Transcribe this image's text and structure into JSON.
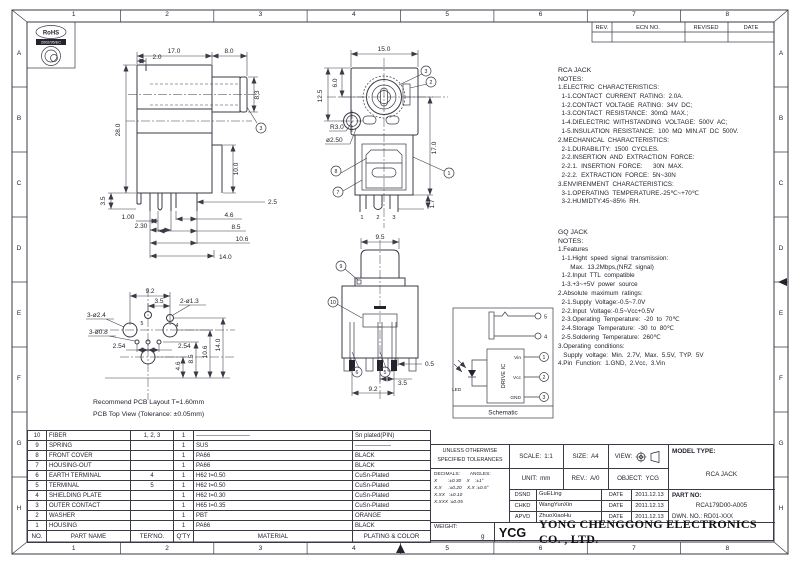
{
  "sheet": {
    "columns": [
      "1",
      "2",
      "3",
      "4",
      "5",
      "6",
      "7",
      "8"
    ],
    "rows": [
      "A",
      "B",
      "C",
      "D",
      "E",
      "F",
      "G",
      "H"
    ],
    "revision": {
      "headers": [
        "REV.",
        "ECN NO.",
        "REVISED",
        "DATE"
      ]
    },
    "rohs": {
      "title": "RoHS",
      "subtitle": "2002/95/EC"
    }
  },
  "notes_rca": {
    "title": "RCA JACK",
    "label": "NOTES:",
    "lines": [
      "1.ELECTRIC  CHARACTERISTICS:",
      "  1-1.CONTACT  CURRENT  RATING:  2.0A.",
      "  1-2.CONTACT  VOLTAGE  RATING:  34V  DC;",
      "  1-3.CONTACT  RESISTANCE:  30mΩ  MAX.;",
      "  1-4.DIELECTRIC  WITHSTANDING  VOLTAGE:  500V  AC;",
      "  1-5.INSULATION  RESISTANCE:  100  MΩ  MIN.AT  DC  500V.",
      "2.MECHANICAL  CHARACTERISTICS:",
      "  2-1.DURABILITY:  1500  CYCLES.",
      "  2-2.INSERTION  AND  EXTRACTION  FORCE:",
      "  2-2.1.  INSERTION  FORCE:      30N  MAX.",
      "  2-2.2.  EXTRACTION  FORCE:  5N~30N",
      "3.ENVIRENMENT  CHARACTERISTICS:",
      "  3-1.OPERATING  TEMPERATURE.-25℃~+70℃",
      "  3-2.HUMIDTY:45~85%  RH."
    ]
  },
  "notes_gq": {
    "title": "GQ JACK",
    "label": "NOTES:",
    "lines": [
      "1.Features",
      "  1-1.Hight  speed  signal  transmission:",
      "       Max.  13.2Mbps,(NRZ  signal)",
      "  1-2.Input  TTL  compatible",
      "  1-3.+3~+5V  power  source",
      "2.Absolute  maximum  ratings:",
      "  2-1.Supply  Voltage:-0.5~7.0V",
      "  2-2.Input  Voltage:-0.5~Vcc+0.5V",
      "  2-3.Operating  Temperature:  -20  to  70℃",
      "  2-4.Storage  Temperature:  -30  to  80℃",
      "  2-5.Soldering  Temperature:  260℃",
      "3.Operating  conditions:",
      "   Supply  voltage:  Min.  2.7V,  Max.  5.5V,  TYP.  5V",
      "4.Pin  Function:  1.GND,  2.Vcc,  3.Vin"
    ]
  },
  "views": {
    "side": {
      "balloon": "3",
      "dims": {
        "w_body": "17.0",
        "w_barrel": "8.0",
        "step": "2.0",
        "h_body": "28.0",
        "h_barrel": "8.3",
        "h_block": "10.0",
        "offset": "2.5",
        "foot": "3.5",
        "p1": "1.00",
        "p2": "2.30",
        "p3": "4.6",
        "p4": "8.5",
        "p5": "10.6",
        "p6": "14.0"
      }
    },
    "front": {
      "dims": {
        "w": "15.0",
        "h1": "12.5",
        "h2": "6.0",
        "r": "R3.0",
        "d": "ø2.50",
        "h": "17.0",
        "pin": "1.7"
      },
      "pin_labels": [
        "1",
        "2",
        "3"
      ],
      "balloons": {
        "top": "3",
        "mid": "2",
        "right": "1",
        "left_top": "8",
        "left_bot": "7"
      }
    },
    "rear": {
      "dims": {
        "w": "9.5",
        "pw": "0.5",
        "p1": "3.5",
        "p2": "9.2"
      },
      "balloons": {
        "top": "9",
        "left": "10",
        "bot1": "6",
        "bot2": "5"
      }
    },
    "pcb": {
      "dims": {
        "w": "9.2",
        "p": "3.5",
        "n1": "2-ø1.3",
        "n2": "3-ø2.4",
        "n3": "3-ø0.8",
        "pitch1": "2.54",
        "pitch2": "2.54",
        "v1": "4.6",
        "v2": "8.5",
        "v3": "10.6",
        "v4": "14.0"
      },
      "hole_labels": [
        "5",
        "4"
      ],
      "captions": [
        "Recommend  PCB  Layout  T=1.60mm",
        "PCB  Top  View  (Tolerance:  ±0.05mm)"
      ]
    },
    "schematic": {
      "caption": "Schematic",
      "ic_label": "DRIVE IC",
      "led_label": "LED",
      "terminals": [
        "5",
        "4"
      ],
      "pins": [
        {
          "name": "Vin",
          "num": "1"
        },
        {
          "name": "Vcc",
          "num": "2"
        },
        {
          "name": "GND",
          "num": "3"
        }
      ]
    }
  },
  "bom": {
    "headers": {
      "no": "NO.",
      "part": "PART NAME",
      "ter": "TER'NO.",
      "qty": "Q'TY",
      "material": "MATERIAL",
      "plating": "PLATING & COLOR"
    },
    "rows": [
      {
        "no": "10",
        "part": "FIBER",
        "ter": "1, 2, 3",
        "qty": "1",
        "material": "—————————",
        "plating": "Sn plated(PIN)"
      },
      {
        "no": "9",
        "part": "SPRING",
        "ter": "",
        "qty": "1",
        "material": "SUS",
        "plating": "——————"
      },
      {
        "no": "8",
        "part": "FRONT COVER",
        "ter": "",
        "qty": "1",
        "material": "PA66",
        "plating": "BLACK"
      },
      {
        "no": "7",
        "part": "HOUSING-OUT",
        "ter": "",
        "qty": "1",
        "material": "PA66",
        "plating": "BLACK"
      },
      {
        "no": "6",
        "part": "EARTH TERMINAL",
        "ter": "4",
        "qty": "1",
        "material": "H62   t=0.50",
        "plating": "CuSn-Plated"
      },
      {
        "no": "5",
        "part": "TERMINAL",
        "ter": "5",
        "qty": "1",
        "material": "H62   t=0.50",
        "plating": "CuSn-Plated"
      },
      {
        "no": "4",
        "part": "SHIELDING PLATE",
        "ter": "",
        "qty": "1",
        "material": "H62   t=0.30",
        "plating": "CuSn-Plated"
      },
      {
        "no": "3",
        "part": "OUTER CONTACT",
        "ter": "",
        "qty": "1",
        "material": "H65   t=0.35",
        "plating": "CuSn-Plated"
      },
      {
        "no": "2",
        "part": "WASHER",
        "ter": "",
        "qty": "1",
        "material": "PBT",
        "plating": "ORANGE"
      },
      {
        "no": "1",
        "part": "HOUSING",
        "ter": "",
        "qty": "1",
        "material": "PA66",
        "plating": "BLACK"
      }
    ]
  },
  "title_block": {
    "tolerance_title1": "UNLESS OTHERWISE",
    "tolerance_title2": "SPECIFIED TOLERANCES",
    "decimals_label": "DECIMALS:",
    "angles_label": "ANGLES:",
    "tol_lines": [
      "X        :±0.30    X    :±1°",
      "X.X     :±0.20    X.X :±0.5°",
      "X.XX   :±0.10",
      "X.XXX :±0.05"
    ],
    "scale_label": "SCALE:",
    "scale": "1:1",
    "size_label": "SIZE:",
    "size": "A4",
    "view_label": "VIEW:",
    "unit_label": "UNIT:",
    "unit": "mm",
    "rev_label": "REV.:",
    "rev": "A/0",
    "object_label": "OBJECT:",
    "object": "YCG",
    "model_label": "MODEL TYPE:",
    "model": "RCA JACK",
    "part_label": "PART NO:",
    "part_no": "RCA179D00-A005",
    "dwn_no": "DWN.  NO.:  RD01-XXX",
    "rows": [
      {
        "role": "DSND",
        "name": "GuELing",
        "date_label": "DATE",
        "date": "2011.12.13"
      },
      {
        "role": "CHKD",
        "name": "WangYunXin",
        "date_label": "DATE",
        "date": "2011.12.13"
      },
      {
        "role": "APVD",
        "name": "ZhuoXiaoHu",
        "date_label": "DATE",
        "date": "2011.12.13"
      }
    ],
    "weight_label": "WEIGHT:",
    "weight_unit": "g",
    "company_logo": "YCG",
    "company_name": "YONG  CHENGGONG  ELECTRONICS  CO. , LTD."
  },
  "colors": {
    "ink": "#23232d",
    "line": "#3a3a46",
    "background": "#ffffff"
  }
}
